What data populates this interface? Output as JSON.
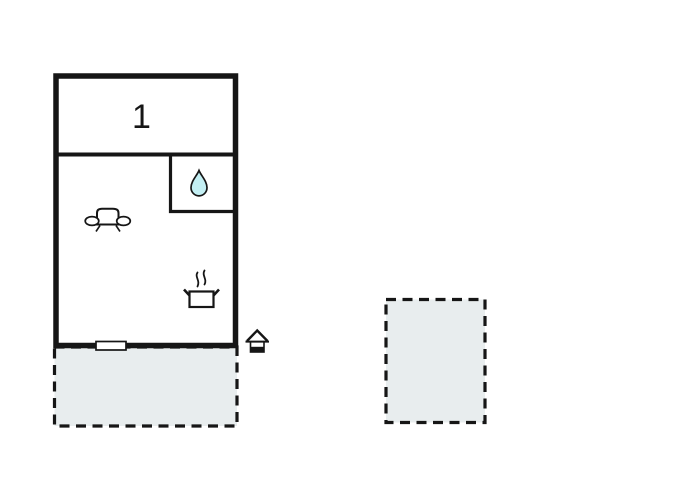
{
  "floor_plan": {
    "room_label": "1",
    "colors": {
      "wall": "#161616",
      "water_drop_fill": "#c3eff3",
      "terrace_fill": "#e8edee",
      "background": "#ffffff"
    },
    "rooms": [
      {
        "name": "bedroom",
        "label": "1"
      },
      {
        "name": "bathroom",
        "icon": "water-drop-icon"
      },
      {
        "name": "living-kitchen",
        "icons": [
          "sofa-icon",
          "cooking-pot-icon"
        ]
      }
    ],
    "outdoor_areas": [
      {
        "name": "terrace-below-building",
        "border": "dashed"
      },
      {
        "name": "terrace-detached-right",
        "border": "dashed"
      }
    ],
    "markers": [
      {
        "name": "entrance-house-icon"
      },
      {
        "name": "window-door-marker"
      }
    ]
  }
}
